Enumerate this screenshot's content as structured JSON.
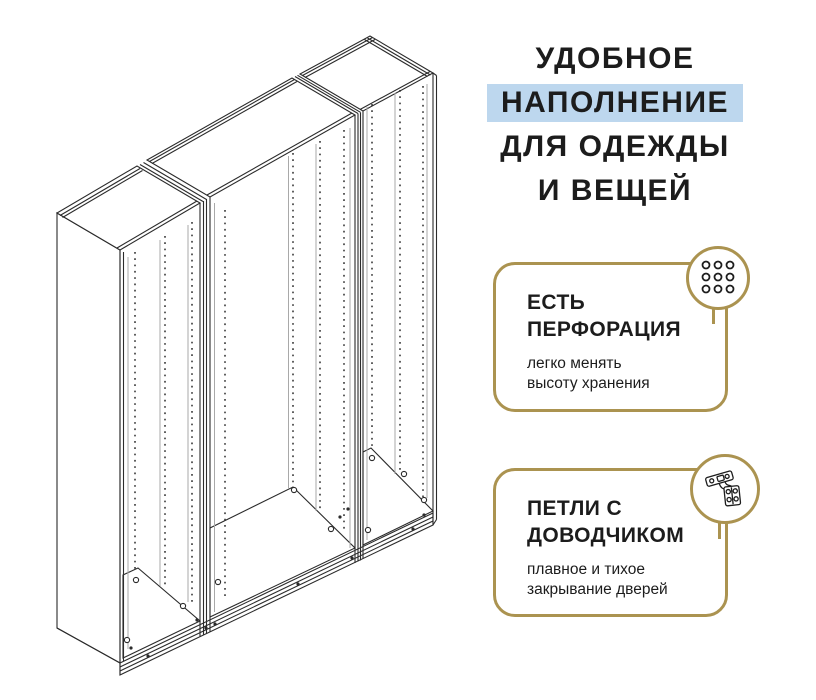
{
  "headline": {
    "lines": [
      "УДОБНОЕ",
      "НАПОЛНЕНИЕ",
      "ДЛЯ ОДЕЖДЫ",
      "И ВЕЩЕЙ"
    ],
    "highlighted_word": "НАПОЛНЕНИЕ"
  },
  "features": [
    {
      "title_line1": "ЕСТЬ",
      "title_line2": "ПЕРФОРАЦИЯ",
      "desc_line1": "легко менять",
      "desc_line2": "высоту хранения",
      "icon": "perforation-grid-icon"
    },
    {
      "title_line1": "ПЕТЛИ С",
      "title_line2": "ДОВОДЧИКОМ",
      "desc_line1": "плавное и тихое",
      "desc_line2": "закрывание дверей",
      "icon": "hinge-icon"
    }
  ],
  "illustration": {
    "subject": "wardrobe-frame-line-drawing",
    "modules": 3
  },
  "colors": {
    "accent_gold": "#ab9350",
    "highlight_blue": "#bdd7ee",
    "text": "#1c1c1c",
    "line_art": "#2b2b2b",
    "background": "#ffffff"
  }
}
